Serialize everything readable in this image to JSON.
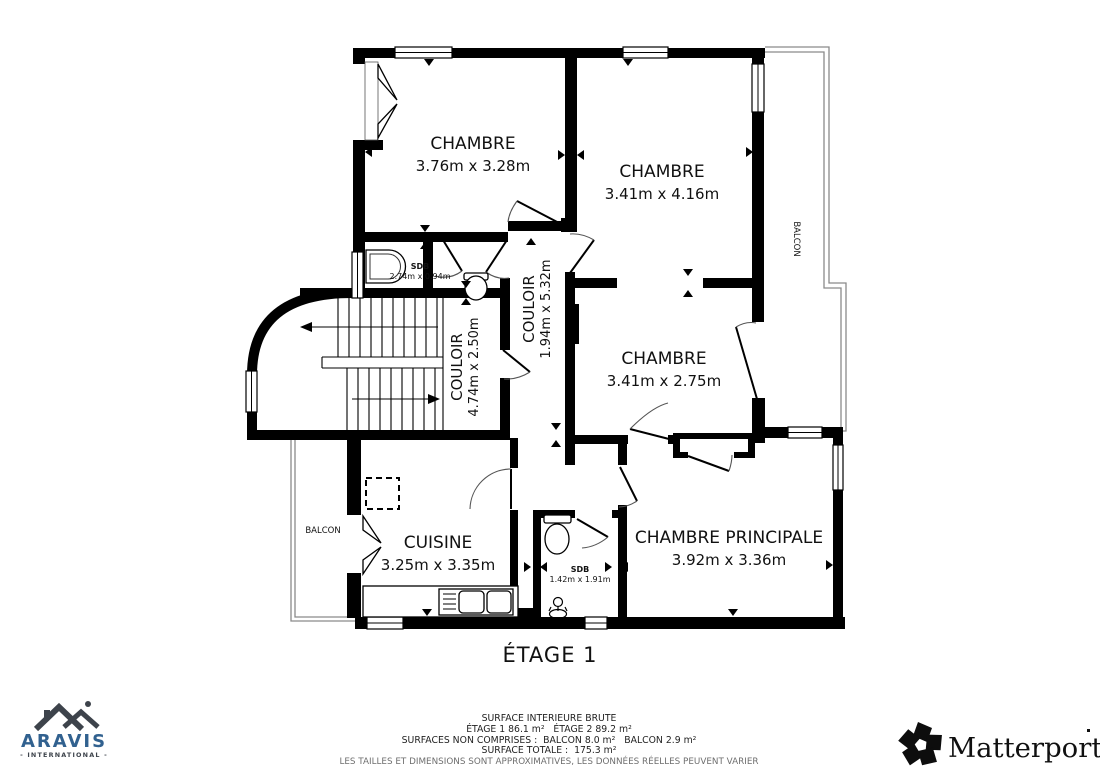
{
  "plan": {
    "title": "ÉTAGE 1",
    "rooms": {
      "chambre1": {
        "name": "CHAMBRE",
        "dims": "3.76m x 3.28m"
      },
      "chambre2": {
        "name": "CHAMBRE",
        "dims": "3.41m x 4.16m"
      },
      "chambre3": {
        "name": "CHAMBRE",
        "dims": "3.41m x 2.75m"
      },
      "principale": {
        "name": "CHAMBRE PRINCIPALE",
        "dims": "3.92m x 3.36m"
      },
      "cuisine": {
        "name": "CUISINE",
        "dims": "3.25m x 3.35m"
      },
      "sdb1": {
        "name": "SDB",
        "dims": "2.74m x 0.94m"
      },
      "sdb2": {
        "name": "SDB",
        "dims": "1.42m x 1.91m"
      },
      "couloir1": {
        "name": "COULOIR",
        "dims": "1.94m x 5.32m"
      },
      "couloir2": {
        "name": "COULOIR",
        "dims": "4.74m x 2.50m"
      },
      "balcon_left": {
        "name": "BALCON"
      },
      "balcon_right": {
        "name": "BALCON"
      }
    }
  },
  "footer": {
    "line1": "SURFACE INTERIEURE BRUTE",
    "line2": "ÉTAGE 1 86.1 m²   ÉTAGE 2 89.2 m²",
    "line3": "SURFACES NON COMPRISES :  BALCON 8.0 m²   BALCON 2.9 m²",
    "line4": "SURFACE TOTALE :  175.3 m²",
    "disclaimer": "LES TAILLES ET DIMENSIONS SONT APPROXIMATIVES, LES DONNÉES RÉELLES PEUVENT VARIER"
  },
  "logos": {
    "aravis": {
      "name": "ARAVIS",
      "subtitle": "- INTERNATIONAL -",
      "brand_color": "#31618f"
    },
    "matterport": {
      "name": "Matterport"
    }
  }
}
